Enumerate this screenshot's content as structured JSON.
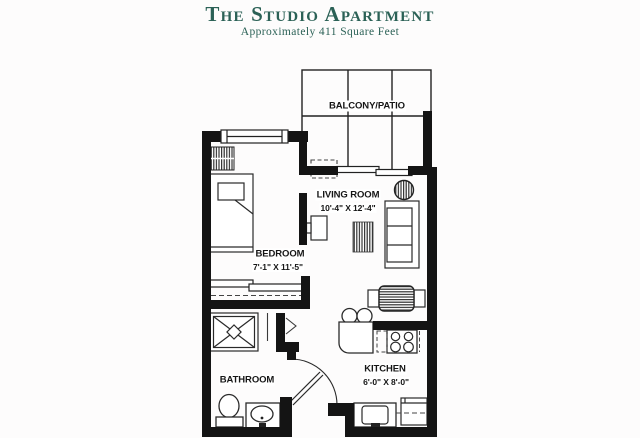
{
  "header": {
    "title": "The Studio Apartment",
    "subtitle": "Approximately 411 Square Feet"
  },
  "rooms": {
    "balcony": {
      "label": "BALCONY/PATIO"
    },
    "living": {
      "label": "LIVING ROOM",
      "dims": "10'-4\" X 12'-4\""
    },
    "bedroom": {
      "label": "BEDROOM",
      "dims": "7'-1\" X 11'-5\""
    },
    "bathroom": {
      "label": "BATHROOM"
    },
    "kitchen": {
      "label": "KITCHEN",
      "dims": "6'-0\" X 8'-0\""
    }
  },
  "colors": {
    "accent_green": "#2b6156",
    "wall_black": "#141414",
    "line_gray": "#2a2a2a"
  }
}
